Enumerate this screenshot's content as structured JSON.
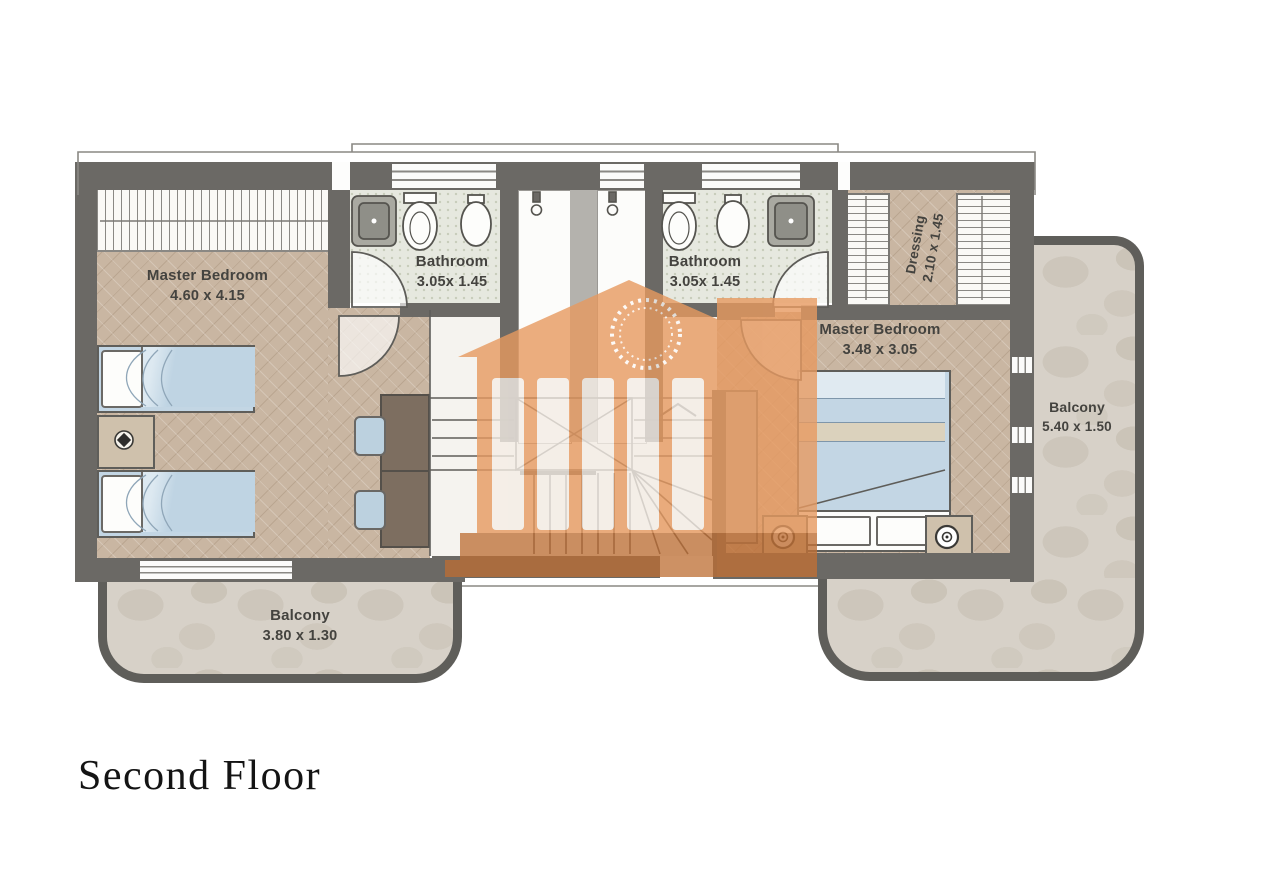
{
  "title": "Second Floor",
  "rooms": {
    "master_bedroom_left": {
      "name": "Master Bedroom",
      "dims": "4.60 x 4.15"
    },
    "bathroom_left": {
      "name": "Bathroom",
      "dims": "3.05x 1.45"
    },
    "bathroom_right": {
      "name": "Bathroom",
      "dims": "3.05x 1.45"
    },
    "dressing": {
      "name": "Dressing",
      "dims": "2.10 x 1.45"
    },
    "master_bedroom_right": {
      "name": "Master Bedroom",
      "dims": "3.48 x 3.05"
    },
    "balcony_right": {
      "name": "Balcony",
      "dims": "5.40 x 1.50"
    },
    "balcony_bottom_left": {
      "name": "Balcony",
      "dims": "3.80 x 1.30"
    }
  },
  "watermark": {
    "description": "classical-building-logo",
    "color": "#e79a60",
    "base_color": "#bd6e34"
  },
  "colors": {
    "wall": "#6b6965",
    "wood_floor": "#c9b6a2",
    "bathroom_tile": "#e6e8df",
    "balcony_stone": "#d7d1c8",
    "bed_blue": "#bfd4e3",
    "label_text": "#44433f"
  }
}
